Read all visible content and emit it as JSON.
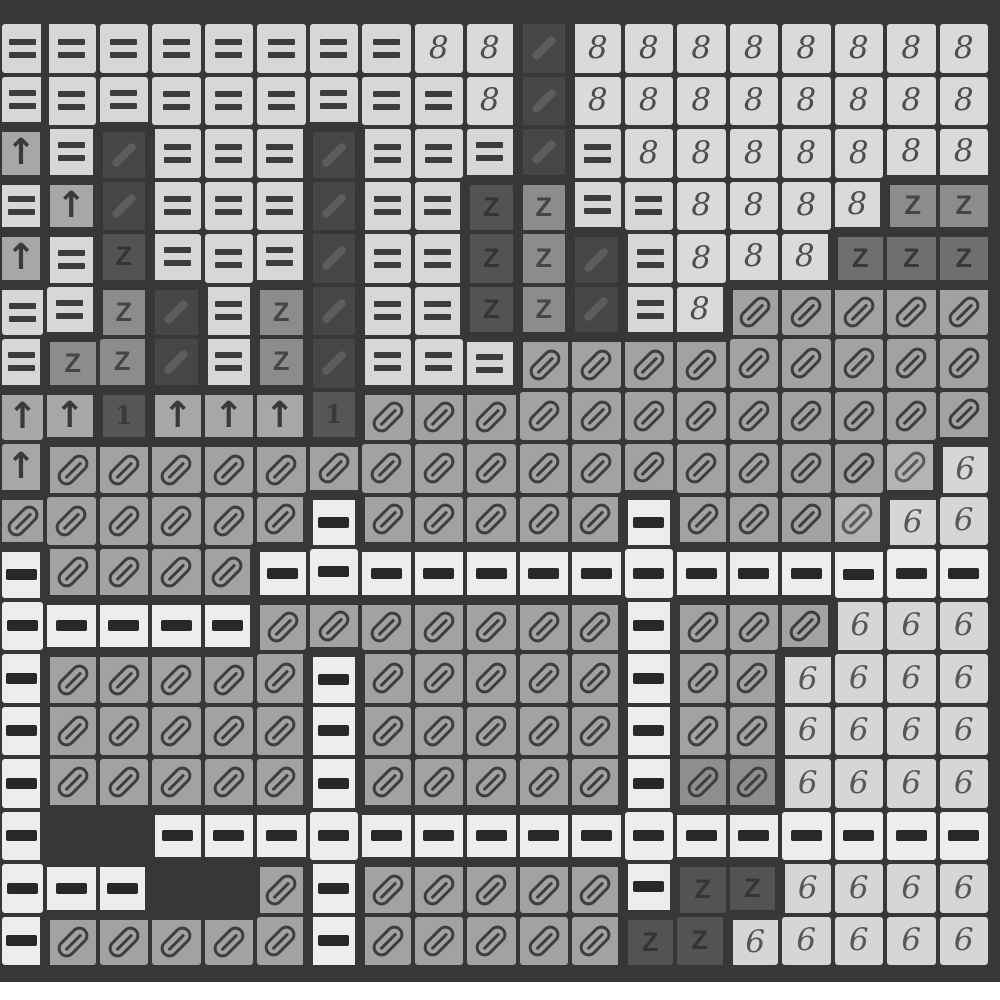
{
  "canvas": {
    "columns": 19,
    "rows": 18,
    "description": "grayscale cross-stitch pattern chart grid"
  },
  "colors": {
    "page_bg": "#373737",
    "grid_line": "#373737",
    "footer_strip": "#ffffff"
  },
  "legend": {
    "e": {
      "name": "equals-symbol",
      "group": "light",
      "shape": "equals",
      "symbol": "=",
      "tile": "#d7d7d7",
      "glyph": "#3c3c3c"
    },
    "8": {
      "name": "eight-symbol",
      "group": "light",
      "shape": "text",
      "symbol": "8",
      "text_class": "gy-num",
      "tile": "#dadada",
      "glyph": "#4d4d4d"
    },
    "6": {
      "name": "six-symbol",
      "group": "light",
      "shape": "text",
      "symbol": "6",
      "text_class": "gy-num",
      "tile": "#d6d6d6",
      "glyph": "#575757"
    },
    "r": {
      "name": "road-dash-symbol",
      "group": "light",
      "shape": "dash",
      "symbol": "-",
      "tile": "#ededed",
      "glyph": "#282828"
    },
    "a": {
      "name": "arrow-up-symbol",
      "group": "arrow",
      "shape": "text",
      "symbol": "↑",
      "text_class": "gy-arrow",
      "tile": "#a7a7a7",
      "glyph": "#3a3a3a"
    },
    "z": {
      "name": "z-symbol",
      "group": "zmed",
      "shape": "text",
      "symbol": "Z",
      "text_class": "gy-z",
      "tile": "#8c8c8c",
      "glyph": "#454545"
    },
    "y": {
      "name": "z-symbol-dim",
      "group": "dark",
      "shape": "text",
      "symbol": "Z",
      "text_class": "gy-z",
      "tile": "#6f6f6f",
      "glyph": "#383838"
    },
    "k": {
      "name": "z-symbol-dark",
      "group": "dark",
      "shape": "text",
      "symbol": "Z",
      "text_class": "gy-z",
      "tile": "#535353",
      "glyph": "#343434"
    },
    "d": {
      "name": "twill-slash-symbol",
      "group": "dark",
      "shape": "slash",
      "symbol": "/",
      "tile": "#464646",
      "glyph": "#5d5d5d"
    },
    "1": {
      "name": "one-symbol",
      "group": "dark",
      "shape": "text",
      "symbol": "1",
      "text_class": "gy-one",
      "tile": "#565656",
      "glyph": "#3a3a3a"
    },
    "o": {
      "name": "slashed-oval-symbol",
      "group": "oval",
      "shape": "capsule",
      "symbol": "0",
      "tile": "#a2a2a2",
      "glyph": "#3e3e3e"
    },
    "O": {
      "name": "slashed-oval-light-symbol",
      "group": "oval",
      "shape": "capsule",
      "symbol": "0",
      "tile": "#b4b4b4",
      "glyph": "#5a5a5a"
    },
    "q": {
      "name": "slashed-oval-dim-symbol",
      "group": "oval",
      "shape": "capsule",
      "symbol": "0",
      "tile": "#8e8e8e",
      "glyph": "#3e3e3e"
    },
    "f": {
      "name": "void-cell",
      "group": "dark",
      "shape": "none",
      "symbol": "",
      "tile": "",
      "glyph": ""
    }
  },
  "grid": [
    "eeeeeeee88d88888888",
    "eeeeeeeee8d88888888",
    "aedeeedeeede8888888",
    "eadeeedeekzee8888zz",
    "aekeeedeekzde888yyy",
    "eezdezdeekzde8ooooo",
    "ezzdezdeeeooooooooo",
    "aa1aaa1oooooooooooo",
    "aooooooooooooooooO6",
    "ooooooroooooroooO66",
    "roooorrrrrrrrrrrrrr",
    "rrrrrooooooorooo666",
    "roooooroooooroo6666",
    "roooooroooooroo6666",
    "rooooorooooorqq6666",
    "rffrrrrrrrrrrrrrrrr",
    "rrrfforooooorkk6666",
    "roooooroooookk66666"
  ]
}
